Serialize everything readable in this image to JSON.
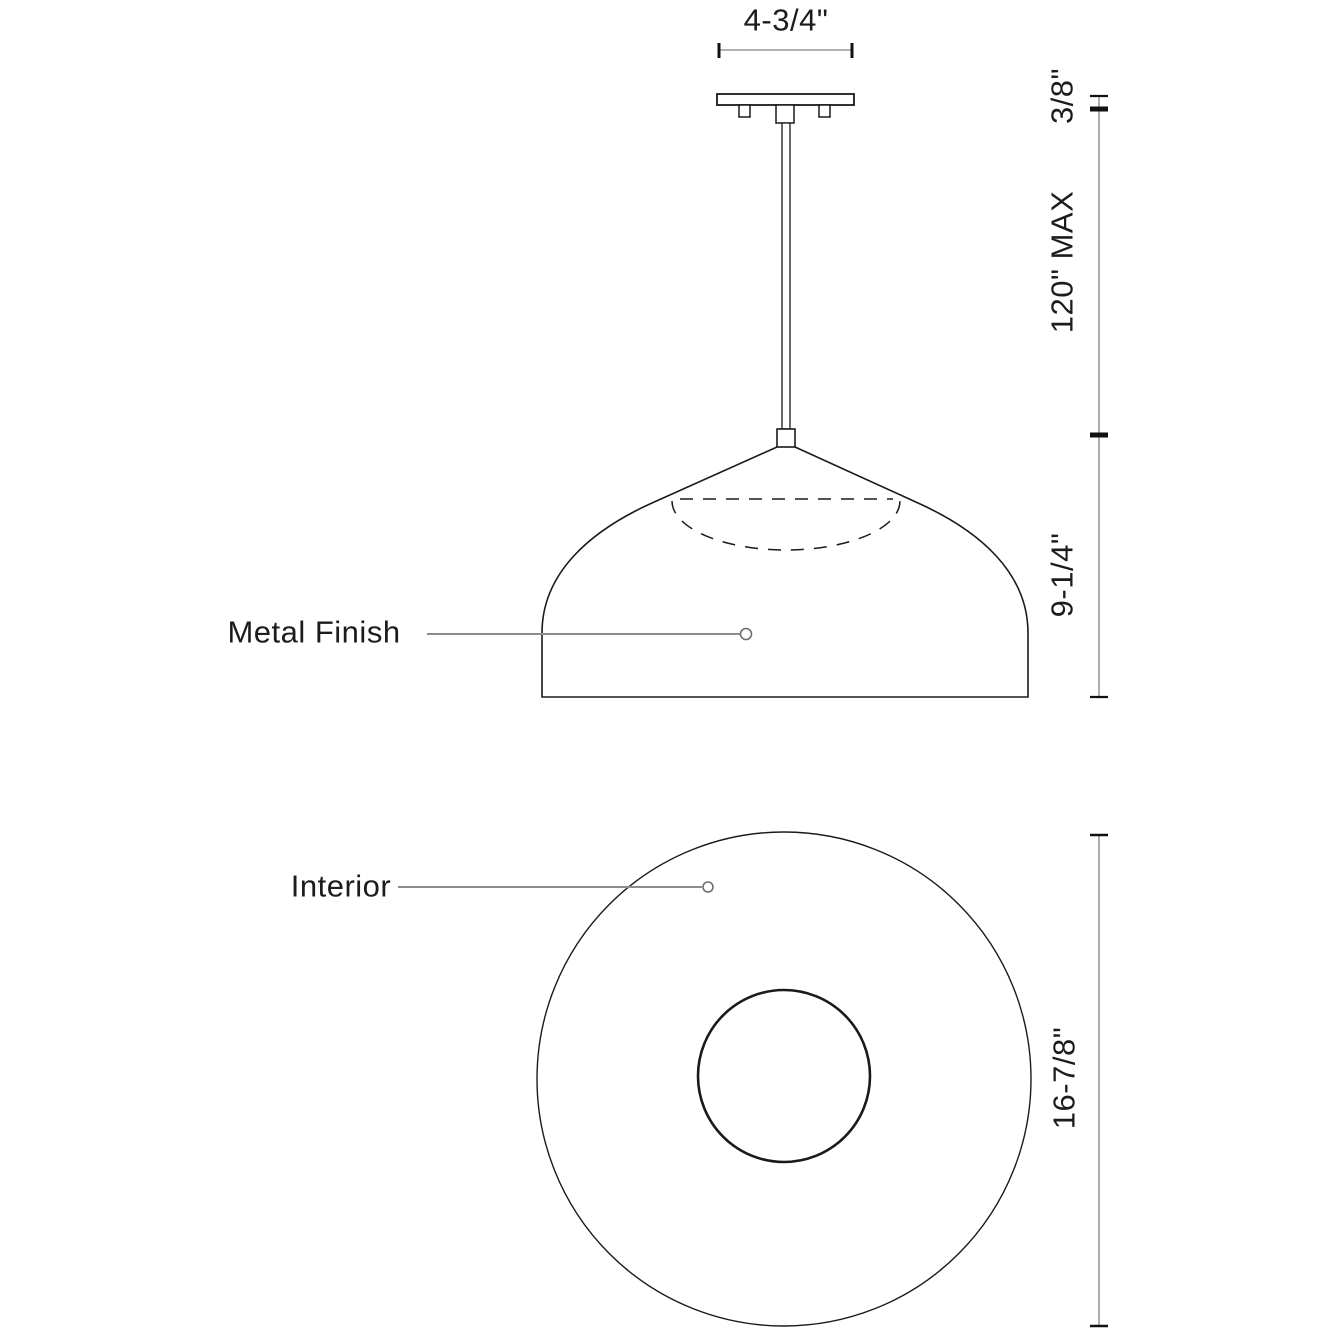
{
  "front_view": {
    "canopy_width": "4-3/4\"",
    "canopy_thickness": "3/8\"",
    "rod_max_length": "120\" MAX",
    "shade_height": "9-1/4\"",
    "callout_metal_finish": "Metal Finish"
  },
  "bottom_view": {
    "callout_interior": "Interior",
    "shade_diameter": "16-7/8\""
  },
  "colors": {
    "object_line": "#1a1a1a",
    "dimension_line": "#9a9a9a",
    "leader_line": "#8c8c8c",
    "tick": "#111111",
    "text": "#1c1c1c",
    "background": "#ffffff"
  }
}
